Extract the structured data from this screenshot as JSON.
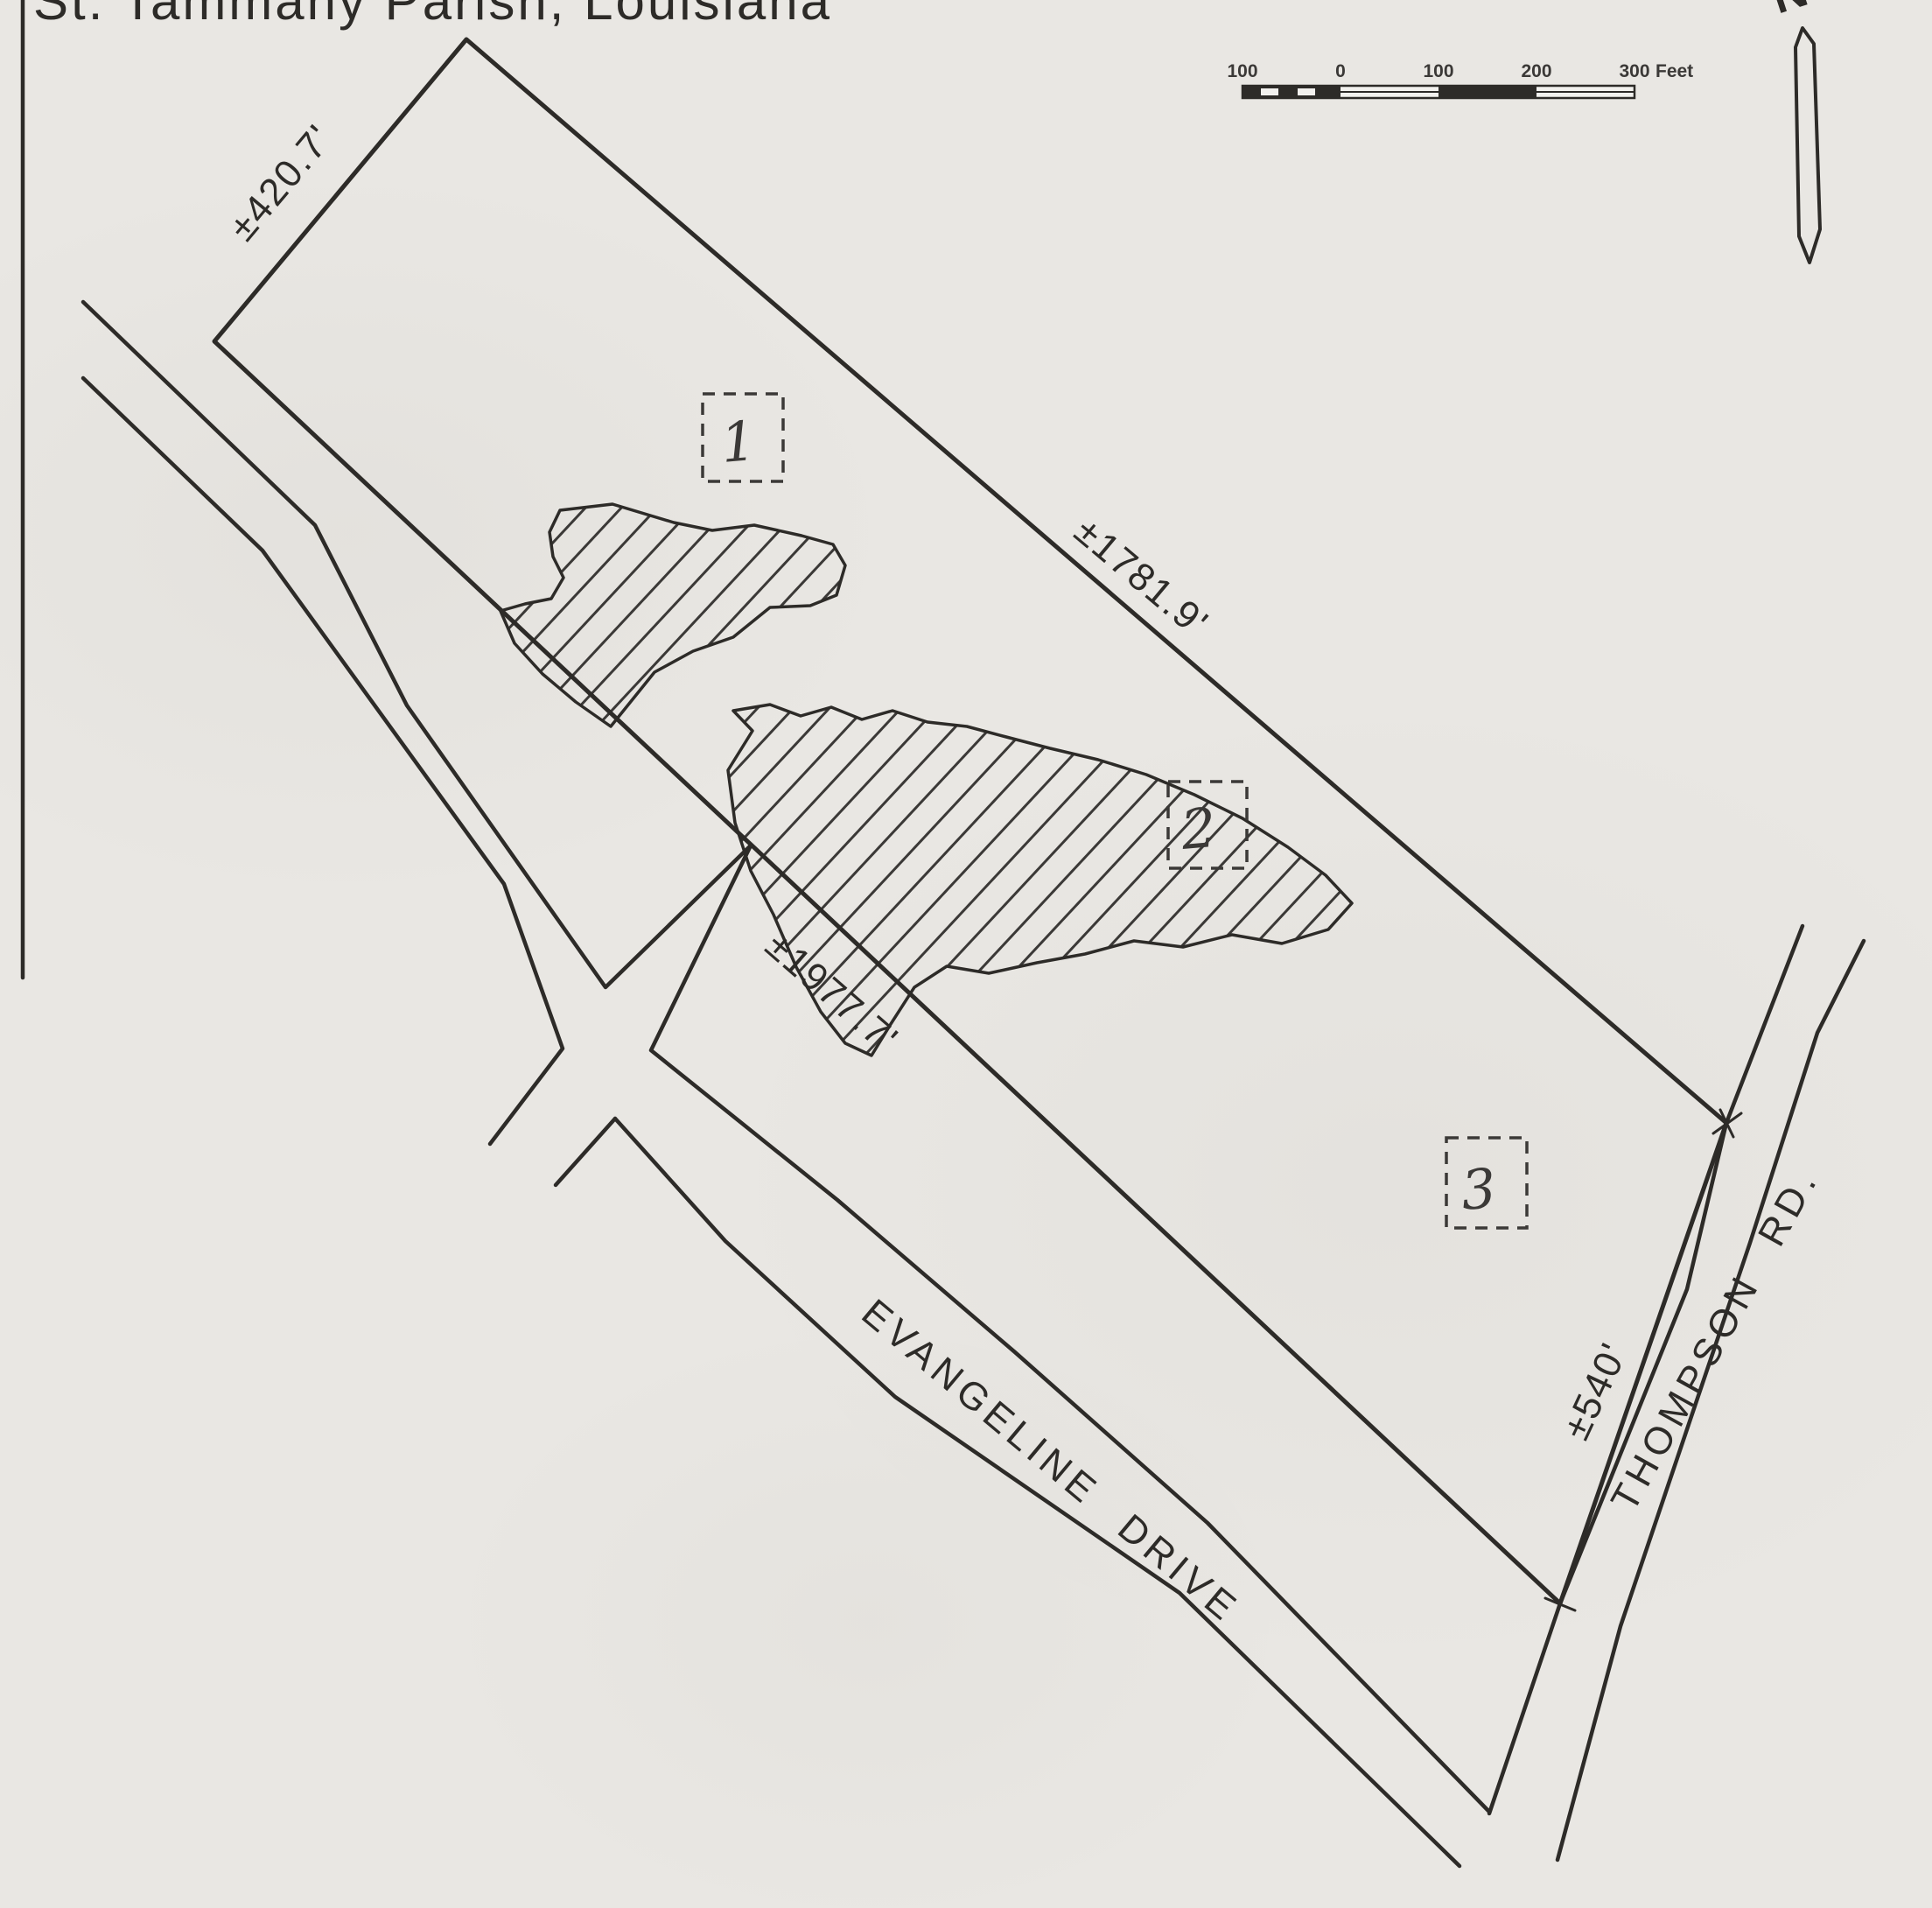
{
  "page": {
    "title": "St. Tammany Parish, Louisiana"
  },
  "colors": {
    "paper": "#e9e7e3",
    "ink": "#2d2b28",
    "ink-soft": "#3b3937"
  },
  "map": {
    "parcel": {
      "dimensions": {
        "nw": "±420.7'",
        "ne": "±1781.9'",
        "sw": "±1977.7'",
        "se": "±540'"
      }
    },
    "roads": [
      {
        "name": "EVANGELINE DRIVE"
      },
      {
        "name": "THOMPSON RD."
      }
    ],
    "areas": [
      {
        "number": "1"
      },
      {
        "number": "2"
      },
      {
        "number": "3"
      }
    ],
    "north_arrow": {
      "label": "N"
    },
    "scale_bar": {
      "ticks": [
        "100",
        "0",
        "100",
        "200",
        "300"
      ],
      "unit": "Feet"
    }
  }
}
